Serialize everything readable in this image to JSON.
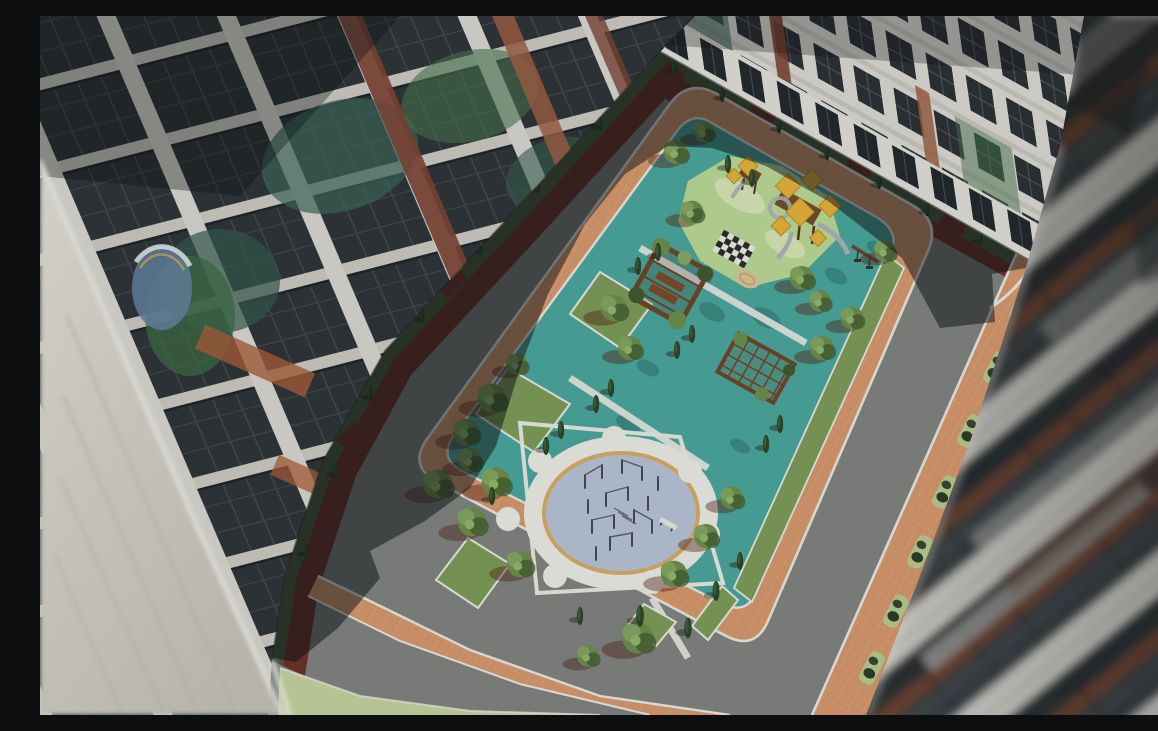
{
  "meta": {
    "title": "Aerial 3D render of a residential courtyard",
    "type": "architectural-visualization",
    "view": "bird's-eye view into an enclosed courtyard between apartment blocks",
    "lighting": "low sun from lower-left; long building shadows across the upper-left of the courtyard"
  },
  "palette": {
    "road": "#7f817e",
    "paver": "#d3946a",
    "paver_light": "#e0a87c",
    "brick_path": "#6b3129",
    "grass": "#7c9a58",
    "grass_dark": "#49583c",
    "grass_pale": "#c3cf9e",
    "teal": "#4aa39a",
    "teal_dark": "#3a8981",
    "play_green": "#b8d594",
    "play_pale": "#d4e3b2",
    "sand": "#d9c093",
    "plaza_blue": "#b5c0d3",
    "ring_white": "#e9e8e3",
    "rim_tan": "#d2a963",
    "curb": "#e6e5df",
    "wood": "#6f4527",
    "canopy": "#e2af3a",
    "slide": "#aab0b5",
    "tree": "#6b8c4c",
    "tree_dark": "#41592f",
    "cypress": "#2d4529",
    "bldg_white": "#dedbd5",
    "bldg_dim": "#bab7b1",
    "glass": "#2b3034",
    "glass_mid": "#3c4247",
    "glass_teal": "#3d6758",
    "glass_green": "#47744e",
    "brick": "#7b4334",
    "brick_light": "#9c5e44",
    "wall_hi": "#ddd9d0",
    "wall_lo": "#c6c2b7",
    "refl_blue": "#65809f",
    "shadow_tint": "rgba(12,15,19,0.5)"
  },
  "scene": {
    "buildings": [
      {
        "id": "left-building",
        "label": "left residential block: glass curtain wall with teal courtyard reflections, white floor slabs and brick piers"
      },
      {
        "id": "top-building",
        "label": "far residential block: white grid facade, dark windows, ground-floor entrances with porticos"
      },
      {
        "id": "right-building",
        "label": "near high-rise at right, out-of-focus diagonal stripes of balconies, glass and brick"
      },
      {
        "id": "foreground-wall",
        "label": "blurred beige end wall of the nearest block, lower-left corner"
      }
    ],
    "courtyard": {
      "road": "asphalt loop around the central park, upper-left part in deep shadow, lower part sunlit",
      "paving": "terracotta paver bands with white curbs",
      "paths": "dark-red brick walkways with entrance stubs along the building bases",
      "park_zones": [
        {
          "id": "playground",
          "label": "children's playground: towers with yellow pyramid canopies, grey slides, swing, giant chessboard and sand circle on a mint island over teal rubber surface"
        },
        {
          "id": "pergola-plaza",
          "label": "teal plaza with two timber pergolas covered in vines"
        },
        {
          "id": "workout-circle",
          "label": "circular calisthenics court: white ring, tan rim, blue-grey pad, steel bars and bench"
        },
        {
          "id": "lawns",
          "label": "lawn patches with deciduous trees and slim cypresses"
        }
      ]
    }
  }
}
